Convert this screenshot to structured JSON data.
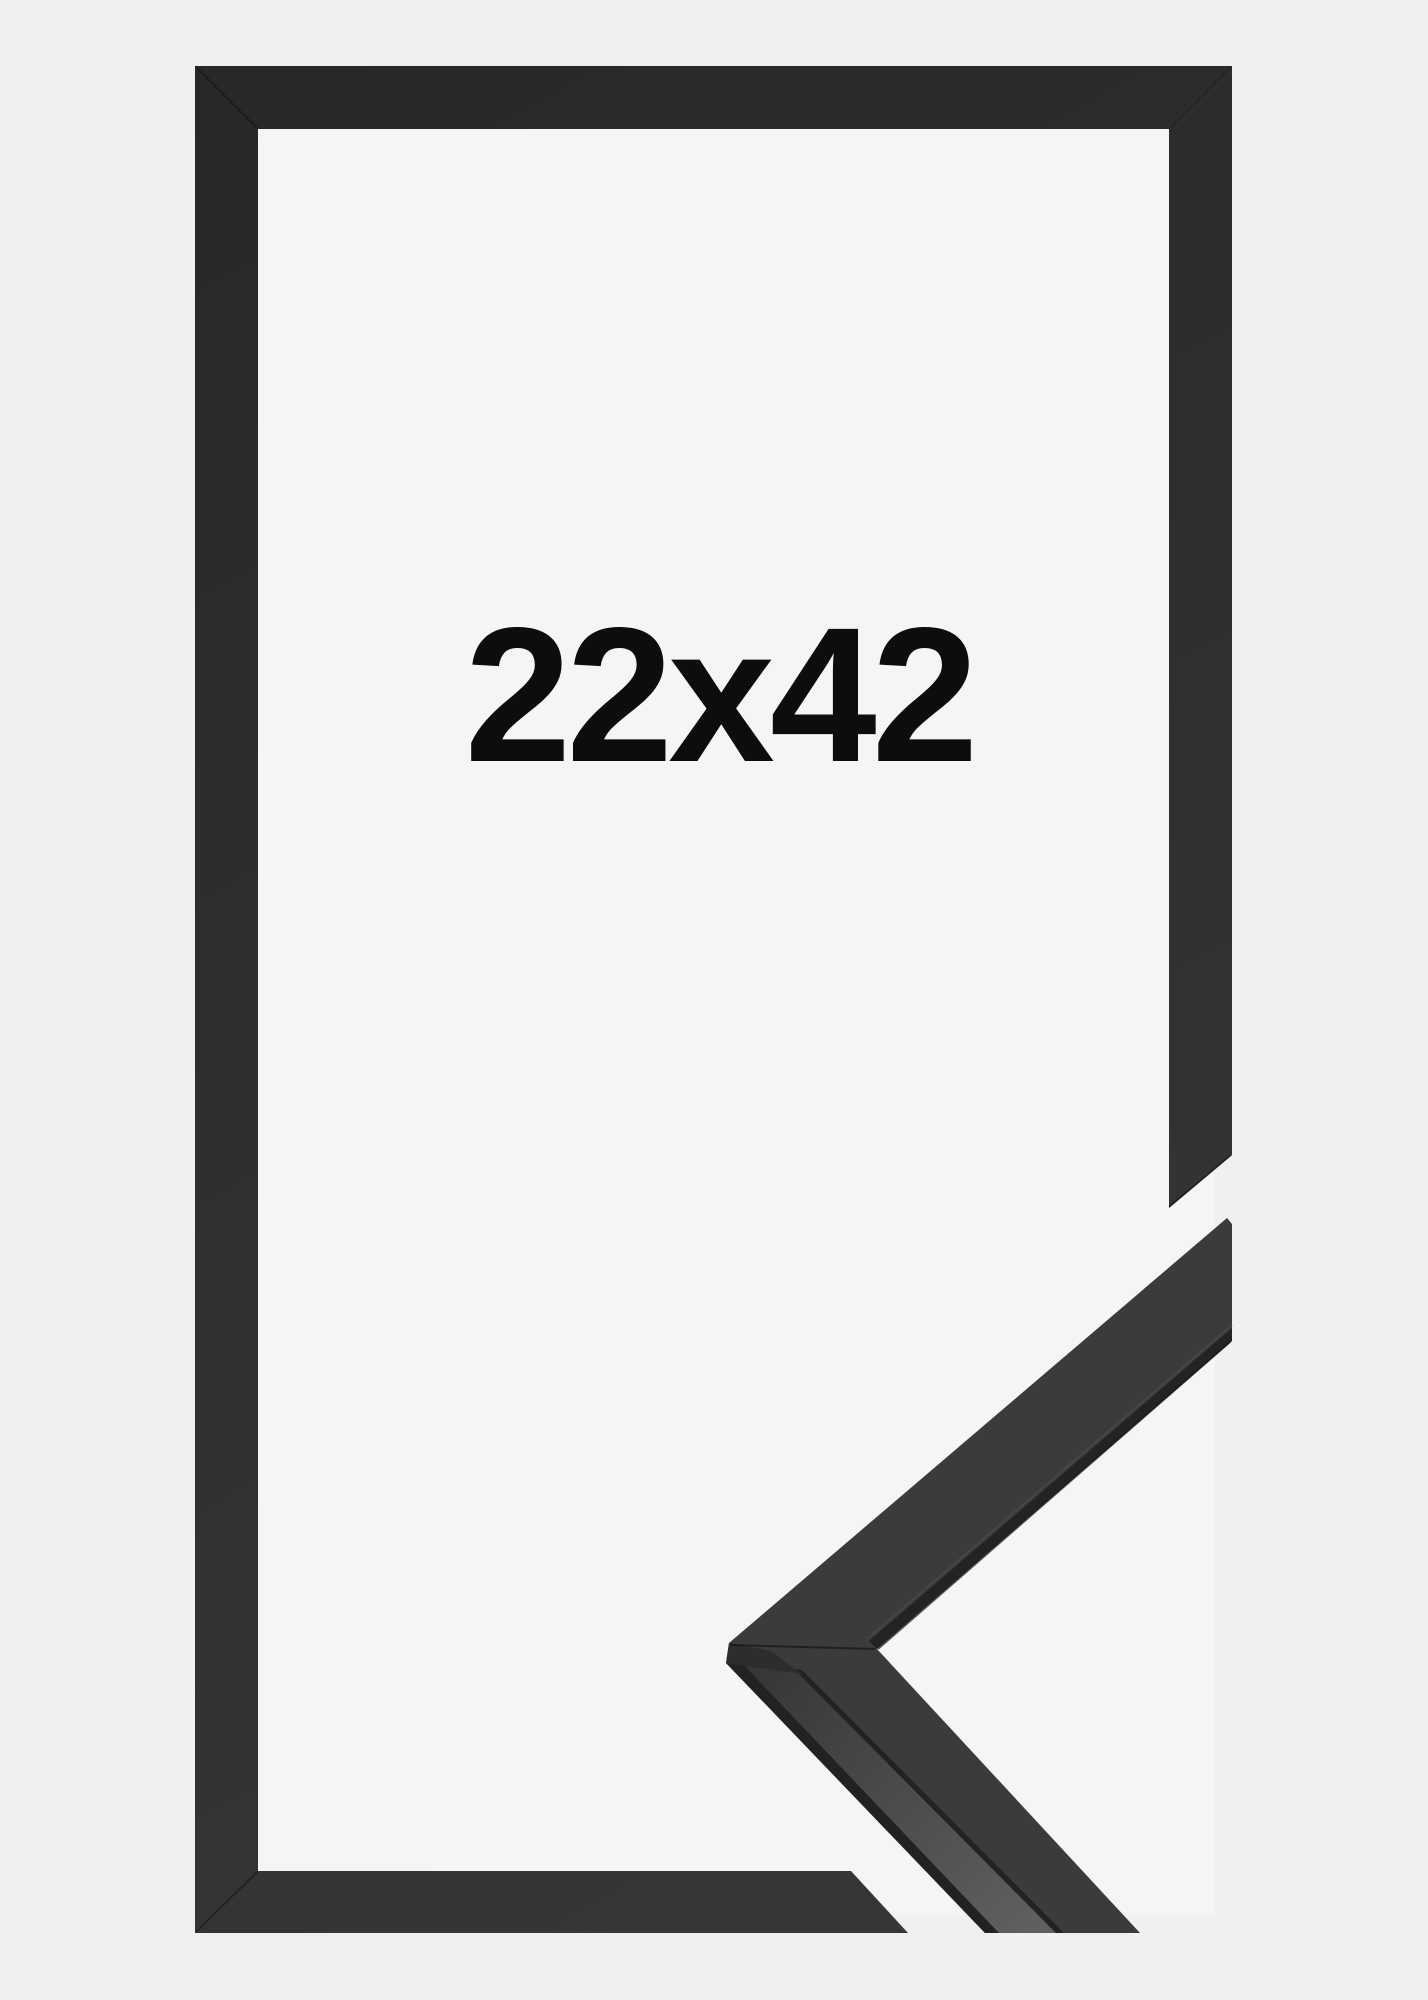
{
  "image": {
    "size_label": "22x42",
    "colors": {
      "background": "#eff0f1",
      "mat": "#f5f5f6",
      "frame_dark": "#272829",
      "frame_light": "#363839",
      "detail_face": "#3a3c3b",
      "detail_side_near": "#333536",
      "detail_side_far": "#5d5f60",
      "detail_edge": "#202223",
      "detail_facet": "#2b2d2e",
      "label": "#0d0d0e"
    }
  }
}
